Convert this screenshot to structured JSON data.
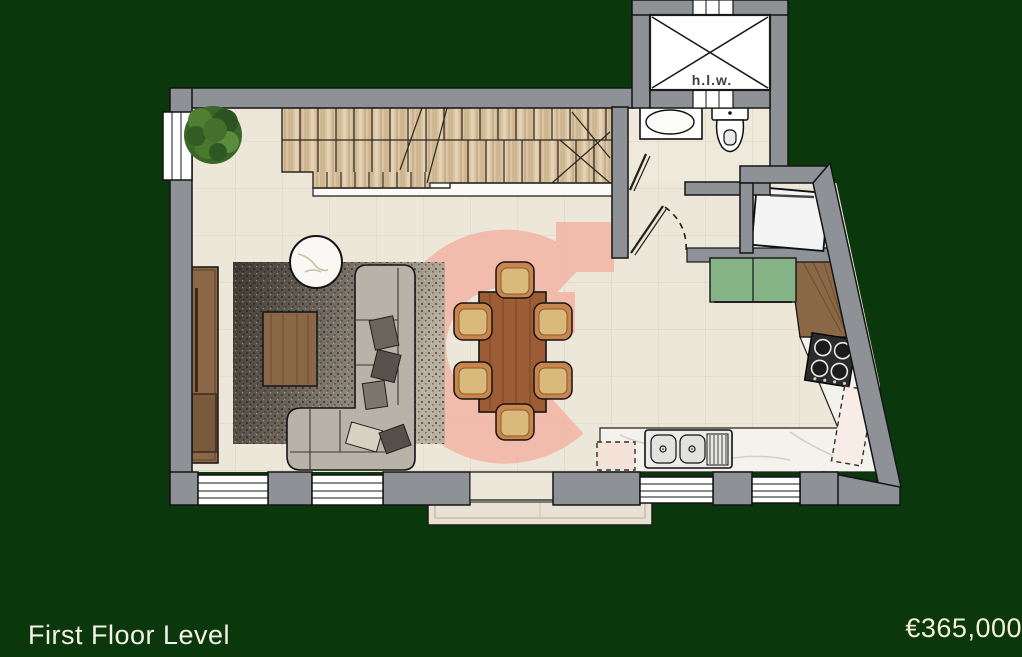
{
  "footer": {
    "title": "First Floor Level",
    "price": "€365,000"
  },
  "plan": {
    "lift_label": "h.l.w.",
    "rooms": [
      "living-dining",
      "kitchen",
      "bathroom",
      "staircase",
      "balcony",
      "lift-shaft"
    ],
    "colors": {
      "background": "#0a380c",
      "wall": "#8e9296",
      "floor": "#ede7da",
      "stairs": "#d8c3a2",
      "watermark_pink": "#f3b2a1",
      "cabinet_green": "#85b385",
      "wood": "#8a6746",
      "dining_wood": "#9c5c36",
      "sofa_gray": "#b8b2a8",
      "text_cream": "#f5f2e6"
    }
  }
}
